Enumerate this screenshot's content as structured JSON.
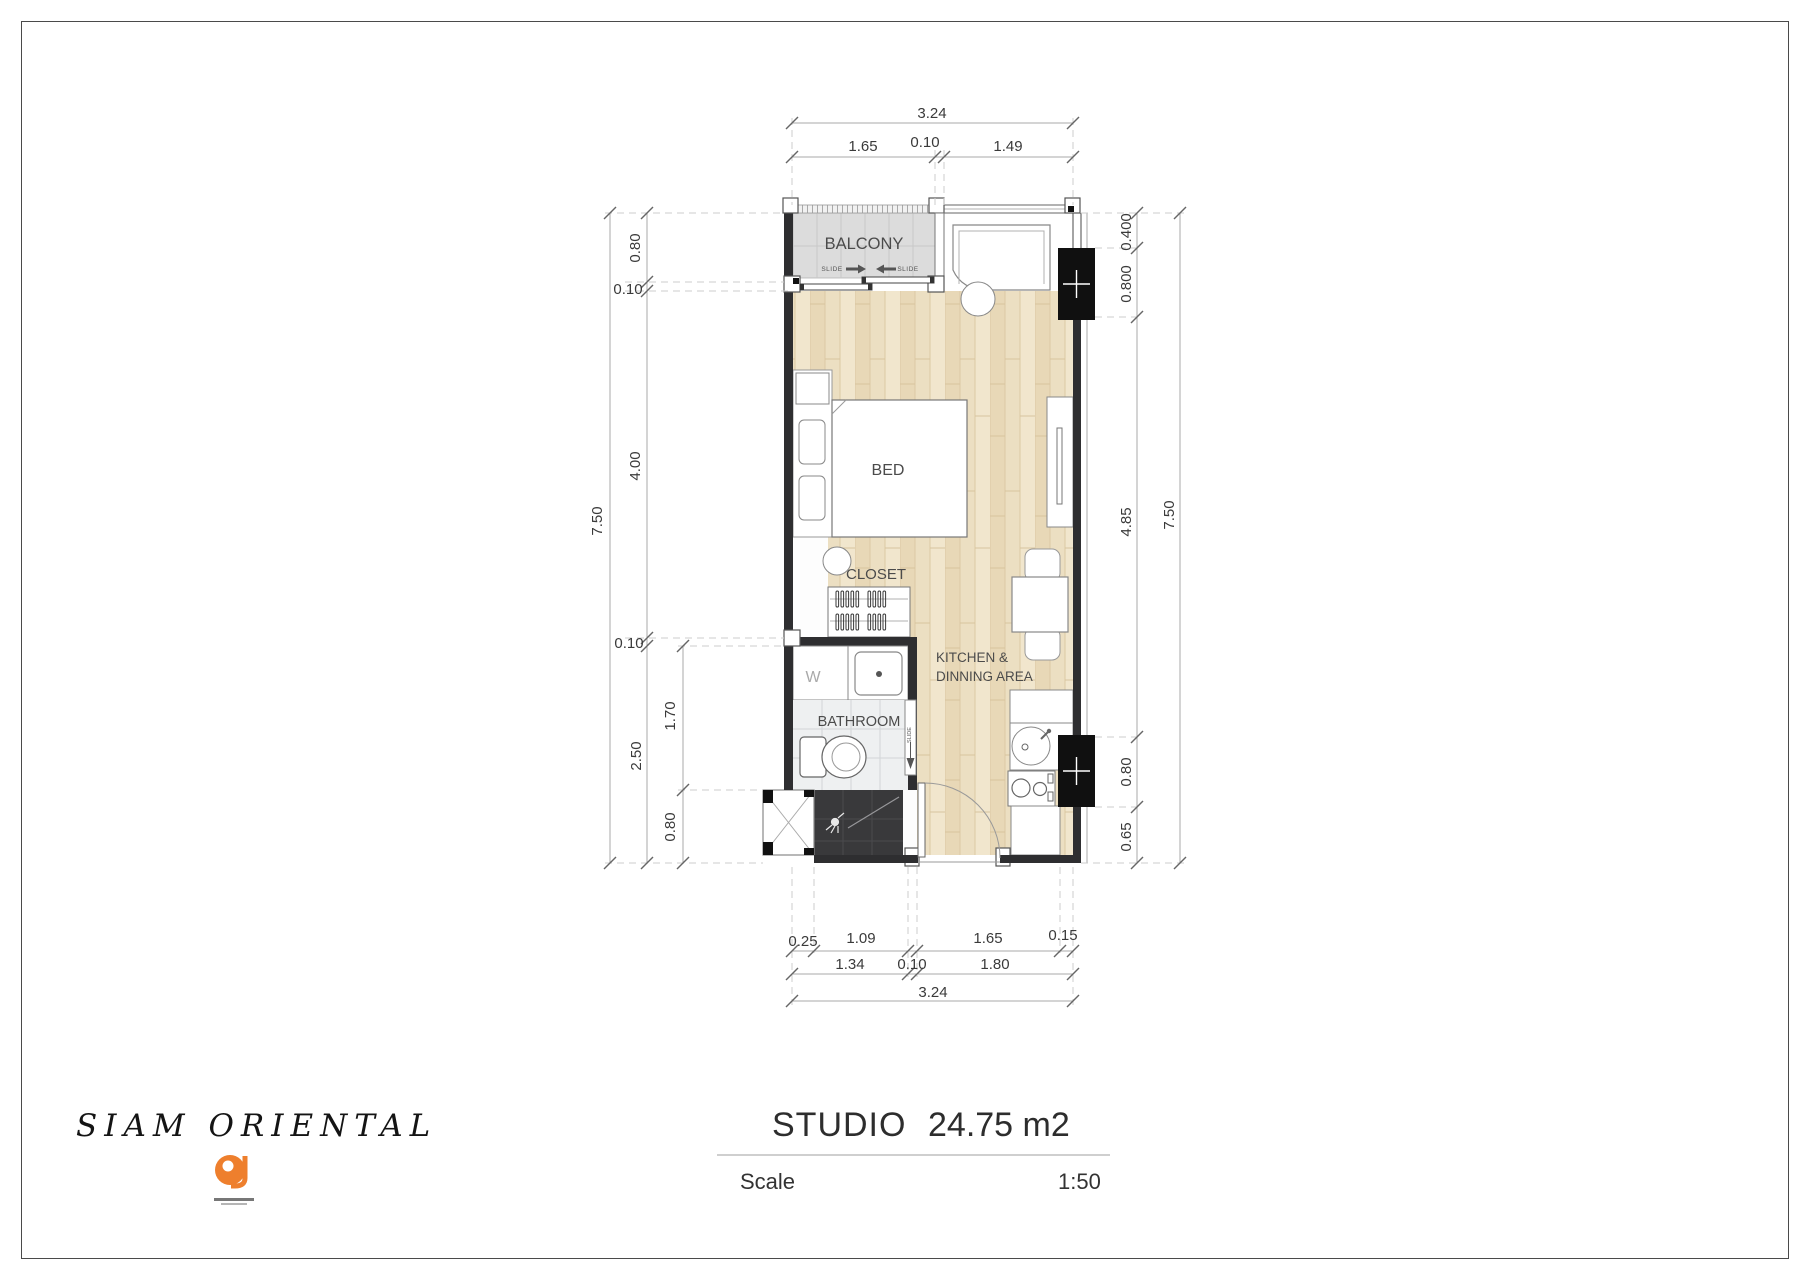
{
  "footer": {
    "brand": "SIAM ORIENTAL",
    "title": "STUDIO",
    "area": "24.75 m2",
    "scale_label": "Scale",
    "scale_value": "1:50"
  },
  "plan": {
    "labels": {
      "balcony": "BALCONY",
      "bed": "BED",
      "closet": "CLOSET",
      "bathroom": "BATHROOM",
      "washer": "W",
      "kitchen1": "KITCHEN &",
      "kitchen2": "DINNING AREA",
      "slide": "SLIDE"
    },
    "dims": {
      "top": {
        "total": "3.24",
        "parts": [
          "1.65",
          "0.10",
          "1.49"
        ]
      },
      "left": {
        "total": "7.50",
        "col1": [
          "0.80",
          "0.10",
          "4.00",
          "0.10",
          "2.50"
        ],
        "col2": [
          "1.70",
          "0.80"
        ]
      },
      "right": {
        "total": "7.50",
        "col1": [
          "0.400",
          "0.800",
          "4.85",
          "0.80",
          "0.65"
        ]
      },
      "bottom": {
        "total": "3.24",
        "row1": [
          "0.25",
          "1.09",
          "1.65",
          "0.15"
        ],
        "row2": [
          "1.34",
          "0.10",
          "1.80"
        ]
      }
    }
  },
  "colors": {
    "brand_accent": "#ee7f2d",
    "wall": "#2e2e30",
    "wood_floor": "#ecdfc2",
    "balcony_floor": "#dcdcdc",
    "shower_floor": "#39393b",
    "column": "#101010"
  }
}
